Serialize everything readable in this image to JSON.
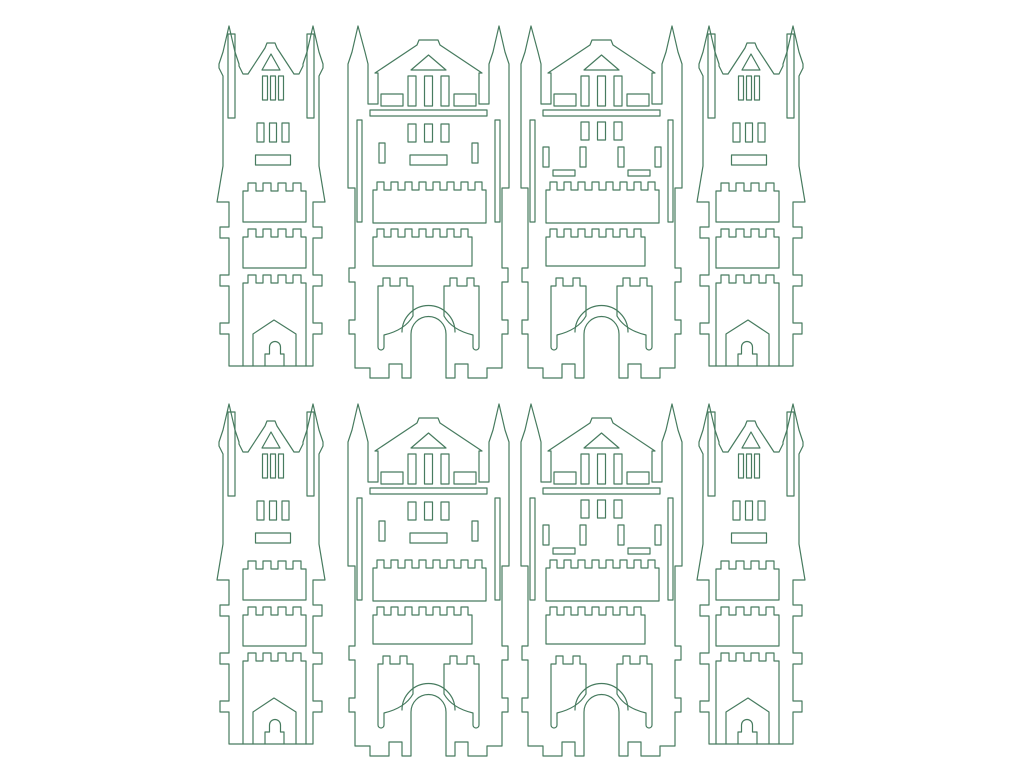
{
  "canvas": {
    "width": 1024,
    "height": 768,
    "background": "#ffffff"
  },
  "line": {
    "color": "#477b5f",
    "width": 1.2
  },
  "sheet": {
    "description": "laser-cut template sheet of castle tower pieces",
    "piece_count": 8,
    "rows": 2,
    "columns": 4
  },
  "shapes": {
    "tower": {
      "w": 112,
      "h": 352,
      "paths": [
        "M14,8 L8,34 L4,46 L4,50 L8,58 L8,148 L2,184 L14,184 L14,209 L5,209 L5,220 L14,220 L14,257 L5,257 L5,268 L14,268 L14,305 L5,305 L5,316 L14,316 L14,348 L98,348 L98,316 L107,316 L107,305 L98,305 L98,268 L107,268 L107,257 L98,257 L98,220 L107,220 L107,209 L98,209 L98,184 L110,184 L104,148 L104,58 L108,50 L108,46 L104,34 L98,8 L92,34 L88,46 L88,48 L84,56 L79,56 L62,30 L60,25 L52,25 L50,30 L33,56 L28,56 L24,48 L24,46 L20,34 Z",
        "M13,16 h7 v84 h-7 Z",
        "M92,16 h7 v84 h-7 Z",
        "M56,36 L47,52 L65,52 Z",
        "M47.5,58 h5 v24 h-5 Z",
        "M55.5,58 h5 v24 h-5 Z",
        "M63.5,58 h5 v24 h-5 Z",
        "M42,105 h7 v19 h-7 Z",
        "M54.5,105 h7 v19 h-7 Z",
        "M67,105 h7 v19 h-7 Z",
        "M40.5,137 h35 v10 h-35 Z",
        "M28,204 V173 h5 v-8 h8 v8 h7 v-8 h8 v8 h7 v-8 h8 v8 h7 v-8 h8 v8 h5 V204 Z",
        "M28,250 V219 h5 v-8 h8 v8 h7 v-8 h8 v8 h7 v-8 h8 v8 h7 v-8 h8 v8 h5 V250 Z",
        "M28,348 V265 h5 v-8 h8 v8 h7 v-8 h8 v8 h7 v-8 h8 v8 h7 v-8 h8 v8 h5 V348",
        "M38,348 V316 L59,302 L81,316 V348",
        "M50,348 V336 H54.5 V329 A5.5,5.5 0 0 1 65.5,329 V336 H69 V348"
      ]
    },
    "gatehouse_a": {
      "w": 167,
      "h": 364,
      "paths": [
        "M13,8 L7,34 L3,46 L3,170 L10,170 L10,250 L4,250 L4,264 L10,264 L10,302 L4,302 L4,316 L10,316 L10,350 L25,350 L25,360 L44,360 L44,346 L57,346 L57,360 L66,360 L66,316 A17.5,17.5 0 0 1 101,316 L101,360 L110,360 L110,346 L123,346 L123,360 L142,360 L142,350 L157,350 L157,316 L163,316 L163,302 L157,302 L157,264 L163,264 L163,250 L157,250 L157,170 L164,170 L164,46 L160,34 L154,8 L148,34 L144,46 L144,86 L134,86 L134,55 L137,55 L95,27 L93,22 L74,22 L72,27 L30,55 L33,55 L33,86 L23,86 L23,46 L20,34 Z",
        "M83.5,37 L66,52 L101,52 Z",
        "M63,58 h8 v30 h-8 Z",
        "M79.5,58 h8 v30 h-8 Z",
        "M96,58 h8 v30 h-8 Z",
        "M36,76 h22 v12 h-22 Z",
        "M109,76 h22 v12 h-22 Z",
        "M25,92 h117 v6 h-117 Z",
        "M12,102 h5 v102 h-5 Z",
        "M150,102 h5 v102 h-5 Z",
        "M63,106 h8 v18 h-8 Z",
        "M79.5,106 h8 v18 h-8 Z",
        "M96,106 h8 v18 h-8 Z",
        "M34,125 h6 v20 h-6 Z",
        "M127,125 h6 v20 h-6 Z",
        "M65,137 h37 v10 h-37 Z",
        "M28,205 V172 h4 v-8 h7 v8 h7 v-8 h7 v8 h7 v-8 h7 v8 h7 v-8 h7 v8 h7 v-8 h7 v8 h7 v-8 h7 v8 h7 v-8 h7 v8 h7 v-8 h7 v8 h4 V205 Z",
        "M28,248 V219 h4 v-8 h7 v8 h7 v-8 h7 v8 h7 v-8 h7 v8 h7 v-8 h7 v8 h7 v-8 h7 v8 h7 v-8 h7 v8 h7 v-8 h7 v8 h4 V248 Z",
        "M33,329 V268 h5 v-8 h7 v8 h10 v-8 h7 v8 h6 V298 Q60,312 39,317 V329 A3,3 0 0 1 33,329 Z",
        "M134,329 V268 h-5 v-8 h-7 v8 h-10 v-8 h-7 v8 h-6 V298 Q107,312 128,317 V329 A3,3 0 0 0 134,329 Z",
        "M57,314 A26.5,26.5 0 0 1 110,314"
      ]
    },
    "gatehouse_b": {
      "w": 167,
      "h": 364,
      "paths": [
        "M13,8 L7,34 L3,46 L3,170 L10,170 L10,250 L4,250 L4,264 L10,264 L10,302 L4,302 L4,316 L10,316 L10,350 L25,350 L25,360 L44,360 L44,346 L57,346 L57,360 L66,360 L66,316 A17.5,17.5 0 0 1 101,316 L101,360 L110,360 L110,346 L123,346 L123,360 L142,360 L142,350 L157,350 L157,316 L163,316 L163,302 L157,302 L157,264 L163,264 L163,250 L157,250 L157,170 L164,170 L164,46 L160,34 L154,8 L148,34 L144,46 L144,86 L134,86 L134,55 L137,55 L95,27 L93,22 L74,22 L72,27 L30,55 L33,55 L33,86 L23,86 L23,46 L20,34 Z",
        "M83.5,37 L66,52 L101,52 Z",
        "M63,58 h8 v30 h-8 Z",
        "M79.5,58 h8 v30 h-8 Z",
        "M96,58 h8 v30 h-8 Z",
        "M36,76 h22 v12 h-22 Z",
        "M109,76 h22 v12 h-22 Z",
        "M25,92 h117 v6 h-117 Z",
        "M12,102 h5 v102 h-5 Z",
        "M150,102 h5 v102 h-5 Z",
        "M63,104 h8 v18 h-8 Z",
        "M79.5,104 h8 v18 h-8 Z",
        "M96,104 h8 v18 h-8 Z",
        "M25,129 h6 v20 h-6 Z",
        "M62,129 h6 v20 h-6 Z",
        "M100,129 h6 v20 h-6 Z",
        "M137,129 h6 v20 h-6 Z",
        "M35,152 h22 v6 h-22 Z",
        "M110,152 h22 v6 h-22 Z",
        "M28,205 V172 h4 v-8 h7 v8 h7 v-8 h7 v8 h7 v-8 h7 v8 h7 v-8 h7 v8 h7 v-8 h7 v8 h7 v-8 h7 v8 h7 v-8 h7 v8 h7 v-8 h7 v8 h4 V205 Z",
        "M28,248 V219 h4 v-8 h7 v8 h7 v-8 h7 v8 h7 v-8 h7 v8 h7 v-8 h7 v8 h7 v-8 h7 v8 h7 v-8 h7 v8 h7 v-8 h7 v8 h4 V248 Z",
        "M33,329 V268 h5 v-8 h7 v8 h10 v-8 h7 v8 h6 V298 Q60,312 39,317 V329 A3,3 0 0 1 33,329 Z",
        "M134,329 V268 h-5 v-8 h-7 v8 h-10 v-8 h-7 v8 h-6 V298 Q107,312 128,317 V329 A3,3 0 0 0 134,329 Z",
        "M57,314 A26.5,26.5 0 0 1 110,314"
      ]
    }
  },
  "instances": [
    {
      "shape": "tower",
      "name": "castle-piece-tower-row1-left",
      "x": 215,
      "y": 18
    },
    {
      "shape": "gatehouse_a",
      "name": "castle-piece-gatehouse-a-row1",
      "x": 345,
      "y": 18
    },
    {
      "shape": "gatehouse_b",
      "name": "castle-piece-gatehouse-b-row1",
      "x": 518,
      "y": 18
    },
    {
      "shape": "tower",
      "name": "castle-piece-tower-row1-right",
      "x": 695,
      "y": 18,
      "mirror": true
    },
    {
      "shape": "tower",
      "name": "castle-piece-tower-row2-left",
      "x": 215,
      "y": 396
    },
    {
      "shape": "gatehouse_a",
      "name": "castle-piece-gatehouse-a-row2",
      "x": 345,
      "y": 396
    },
    {
      "shape": "gatehouse_b",
      "name": "castle-piece-gatehouse-b-row2",
      "x": 518,
      "y": 396
    },
    {
      "shape": "tower",
      "name": "castle-piece-tower-row2-right",
      "x": 695,
      "y": 396,
      "mirror": true
    }
  ]
}
